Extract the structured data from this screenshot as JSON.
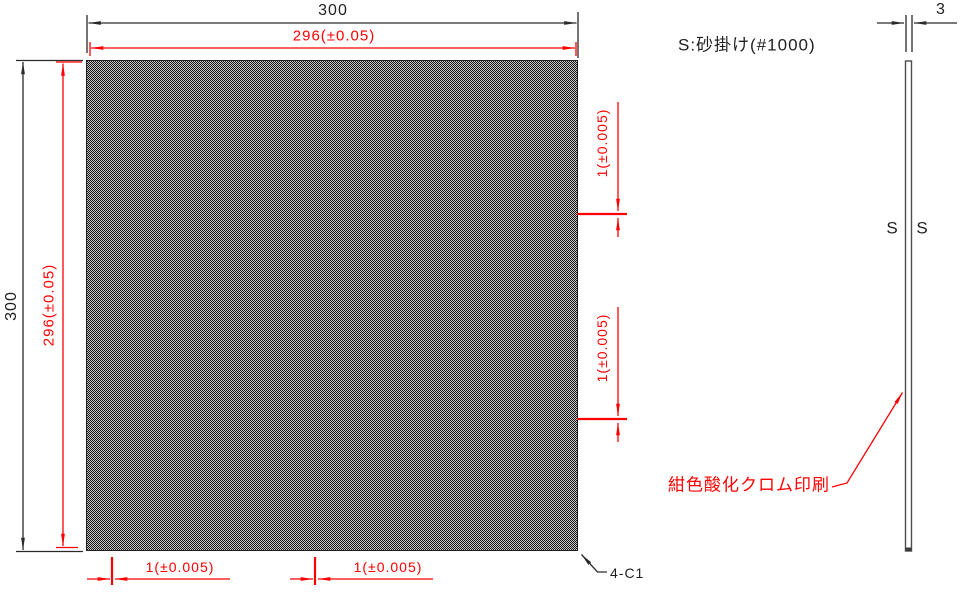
{
  "front_view": {
    "outer_width": "300",
    "effective_width": "296(±0.05)",
    "outer_height": "300",
    "effective_height": "296(±0.05)",
    "right_pitch_top": "1(±0.005)",
    "right_pitch_bottom": "1(±0.005)",
    "bottom_pitch_left": "1(±0.005)",
    "bottom_pitch_right": "1(±0.005)",
    "chamfer_note": "4-C1"
  },
  "side_view": {
    "thickness": "3",
    "surface_mark_left": "S",
    "surface_mark_right": "S"
  },
  "notes": {
    "sand_blast": "S:砂掛け(#1000)",
    "print": "紺色酸化クロム印刷"
  },
  "colors": {
    "dimension_red": "#fe0000",
    "line_dark": "#2a2a2a",
    "side_view_edge": "#4d4d4d"
  }
}
